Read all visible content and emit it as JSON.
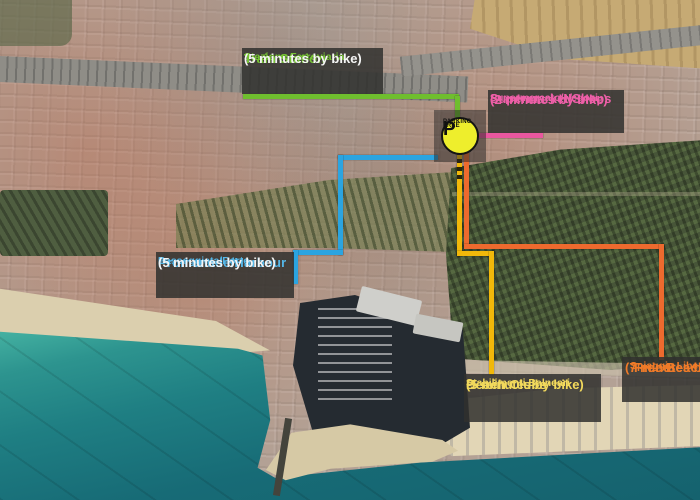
{
  "map": {
    "kind": "annotated-aerial-photo",
    "colors": {
      "sea": "#1f7f83",
      "sand": "#dbcfae",
      "forest": "#475538",
      "urban": "#b3a195",
      "label_background": "#303030"
    }
  },
  "pin": {
    "line1": "FREE",
    "line2": "PARKING",
    "letter": "P",
    "fill_color": "#eeee2c"
  },
  "destinations": [
    {
      "id": "train-station",
      "title": "Train Station",
      "subtitle": "Stazione Ferroviaria",
      "time": "(5 minutes by bike)",
      "title_color": "#76c434",
      "time_color": "#f5f5f5",
      "route_color": "#6fbe2e"
    },
    {
      "id": "supermarket-shops",
      "title": "Supermarket/Shops",
      "subtitle": "Supermercato/Negozi",
      "time": "(2 minutes by bike)",
      "title_color": "#ee5fa8",
      "time_color": "#ee5fa8",
      "route_color": "#e9579f"
    },
    {
      "id": "promenade-harbour",
      "title": "Promenade/Harbour",
      "subtitle": "Passeggiata/Porto",
      "time": "(5 minutes by bike)",
      "title_color": "#55b7e8",
      "time_color": "#f5f5f5",
      "route_color": "#2ba4e0"
    },
    {
      "id": "beach-clubs",
      "title": "Beach Clubs",
      "subtitle": "Stabilimenti Balneari",
      "time": "(5 minutes by bike)",
      "title_color": "#f2d95c",
      "time_color": "#f2d95c",
      "route_color": "#f1b80a"
    },
    {
      "id": "free-beach",
      "title": "Free Beach",
      "subtitle": "Spiaggia Libera",
      "time": "(7 minutes by bike)",
      "title_color": "#f07b28",
      "time_color": "#f07b28",
      "route_color": "#ed6a2e"
    }
  ]
}
